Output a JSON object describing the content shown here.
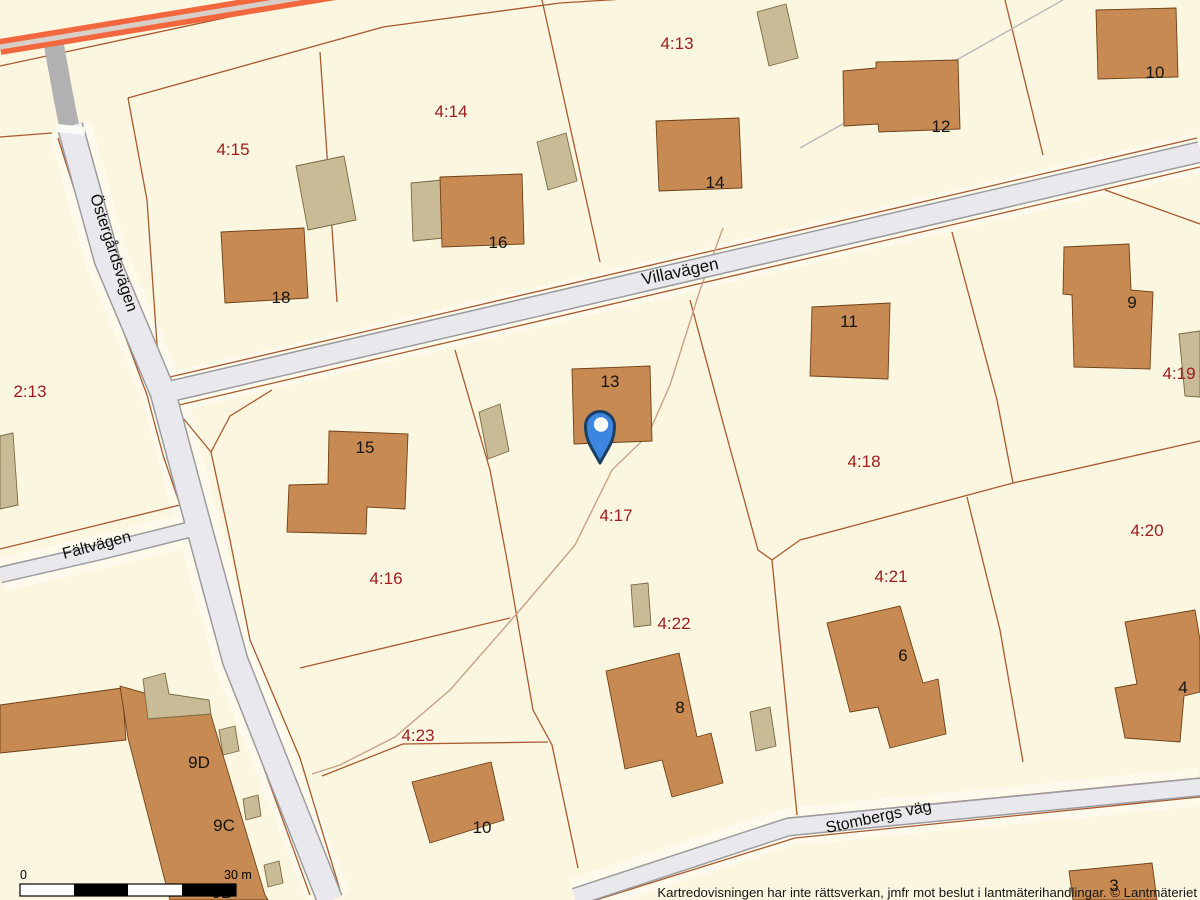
{
  "labels": {
    "parcels": [
      "4:13",
      "4:14",
      "4:15",
      "2:13",
      "4:16",
      "4:17",
      "4:18",
      "4:19",
      "4:20",
      "4:21",
      "4:22",
      "4:23"
    ],
    "buildings": [
      "18",
      "16",
      "14",
      "12",
      "10",
      "9",
      "11",
      "13",
      "15",
      "9D",
      "9C",
      "9B",
      "8",
      "6",
      "10",
      "4",
      "3"
    ],
    "streets": {
      "villavagen": "Villavägen",
      "ostergardsvagen": "Östergårdsvägen",
      "faltvagen": "Fältvägen",
      "stombergsvag": "Stombergs väg"
    }
  },
  "scale_bar": {
    "start": "0",
    "end": "30 m"
  },
  "attribution": "Kartredovisningen har inte rättsverkan, jmfr mot beslut i lantmäterihandlingar. © Lantmäteriet",
  "marker": {
    "name": "location-pin",
    "parcel": "4:17"
  },
  "colors": {
    "bg": "#fbf6df",
    "halo": "#fdfaec",
    "road-fill": "#e9e9ed",
    "road-casing": "#9c9ca0",
    "road-dark": "#b1b1b4",
    "highway": "#f3673e",
    "highway-center": "#d8cfc8",
    "parcel-line": "#a85a30",
    "footpath": "#c8a283",
    "building": "#c78a52",
    "building-stroke": "#6e4119",
    "outbuilding": "#c8bb95",
    "outbuilding-stroke": "#7a6a45",
    "parcel-label": "#9e1b1e",
    "marker": "#3c86e0",
    "marker-stroke": "#1d3f63"
  }
}
